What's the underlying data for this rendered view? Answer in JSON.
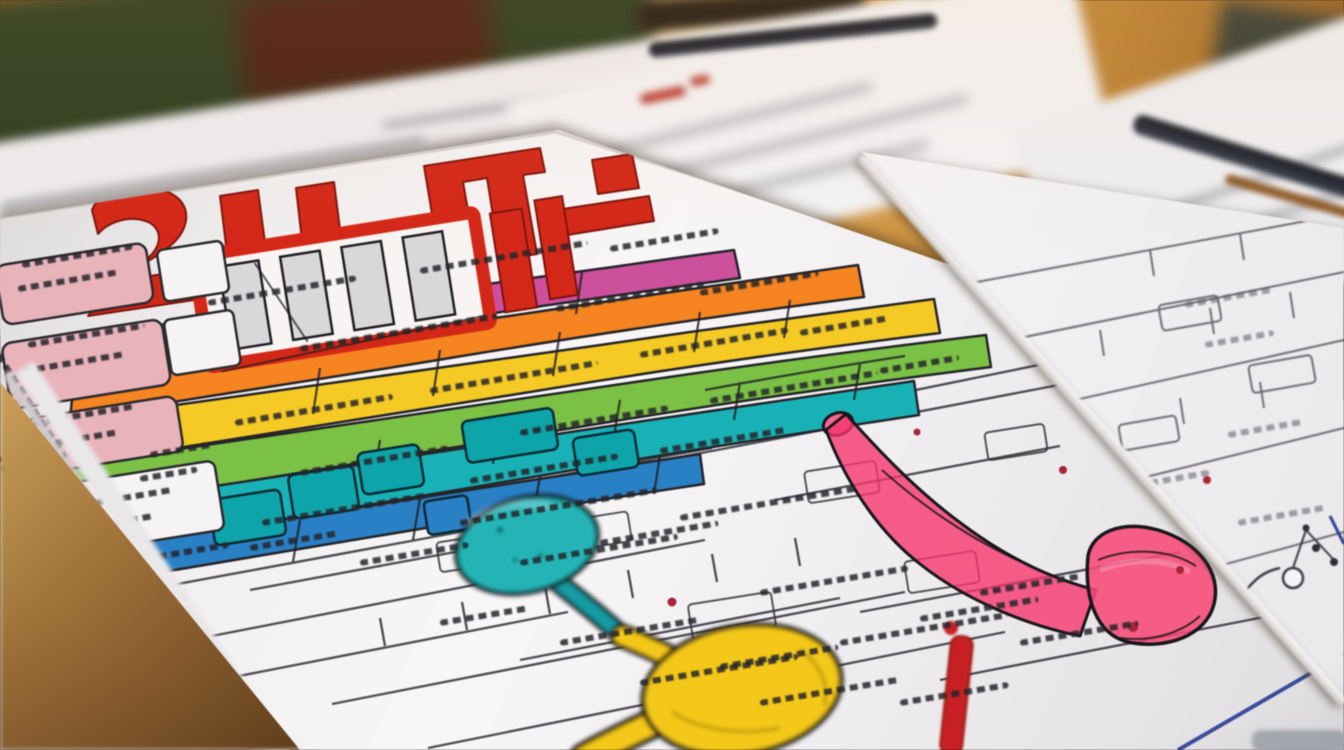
{
  "scene": {
    "type": "photograph",
    "subject": "hand-drawn rainbow flowchart poster lying on a wooden desk with pens and paper sheets",
    "handwriting": "illegible"
  },
  "palette": {
    "paper": "#f2f0f2",
    "ink": "#2b2b30",
    "desk_wood": "#b9853f",
    "desk_mat": "#2d3c22",
    "dark_object": "#3a4036",
    "red": "#cc2a1b",
    "red_dark": "#7a150e",
    "pink_cell": "#e6b3ba",
    "bar_gray": "#d9d6da",
    "ribbon_pink": "#ee3a6e",
    "ribbon_blob": "#ef4c77",
    "marker_red": "#bf2326",
    "teal_node": "#29b2b4",
    "teal_stem": "#1a9aa0",
    "yellow_node": "#f1c722",
    "pen_dark": "#23252b",
    "pencil_brown": "#8a5a2b",
    "blue_line": "#2c3f8f",
    "grid_line": "#33333b"
  },
  "poster": {
    "bands": [
      {
        "name": "band-magenta",
        "color": "#c8529b"
      },
      {
        "name": "band-orange",
        "color": "#ef8527"
      },
      {
        "name": "band-yellow",
        "color": "#f2c92d"
      },
      {
        "name": "band-green",
        "color": "#7dbf4a"
      },
      {
        "name": "band-teal",
        "color": "#1fb0b4"
      },
      {
        "name": "band-blue",
        "color": "#2e7fc0"
      }
    ]
  },
  "objects": [
    {
      "name": "pen-top"
    },
    {
      "name": "pen-right"
    },
    {
      "name": "pencil-right"
    },
    {
      "name": "ruled-sheet-top-left"
    },
    {
      "name": "bright-sheet-top-center"
    },
    {
      "name": "back-sheet-top-right"
    },
    {
      "name": "overlap-map-sheet-right"
    },
    {
      "name": "teal-node"
    },
    {
      "name": "yellow-node"
    },
    {
      "name": "pink-ribbon"
    },
    {
      "name": "red-marker"
    },
    {
      "name": "red-glyphs"
    },
    {
      "name": "bar-frame"
    }
  ]
}
